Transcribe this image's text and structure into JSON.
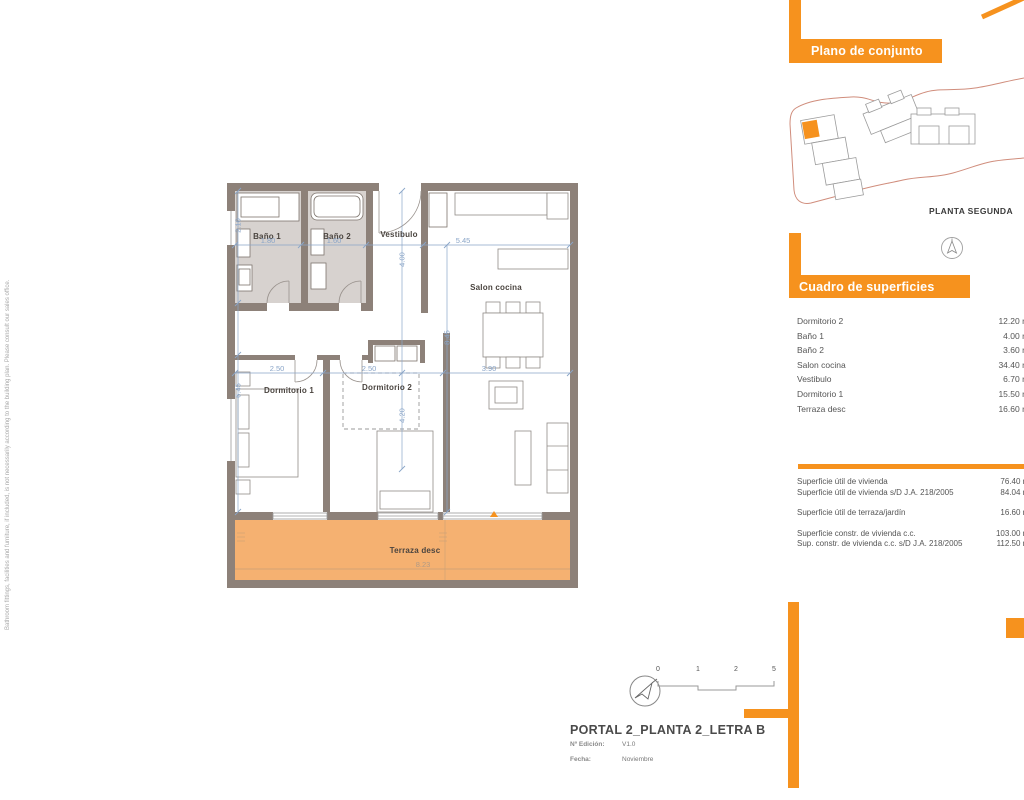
{
  "colors": {
    "accent": "#F6921E",
    "wall": "#8D8179",
    "terrace_fill": "#F5B171",
    "bath_floor": "#D7D2CF",
    "dimension_blue": "#8AA5C8",
    "site_boundary": "#D08D7C"
  },
  "side_note": "Bathroom fittings, facilities and furniture, if included, is not necessarily according to the building plan. Please consult our sales office.",
  "site_plan": {
    "header": "Plano de conjunto",
    "caption": "PLANTA SEGUNDA"
  },
  "surfaces": {
    "header": "Cuadro de superficies",
    "rows": [
      {
        "label": "Dormitorio 2",
        "value": "12.20 m²"
      },
      {
        "label": "Baño 1",
        "value": "4.00 m²"
      },
      {
        "label": "Baño 2",
        "value": "3.60 m²"
      },
      {
        "label": "Salon cocina",
        "value": "34.40 m²"
      },
      {
        "label": "Vestibulo",
        "value": "6.70 m²"
      },
      {
        "label": "Dormitorio 1",
        "value": "15.50 m²"
      },
      {
        "label": "Terraza desc",
        "value": "16.60 m²"
      }
    ],
    "summary": [
      {
        "label": "Superficie útil de vivienda",
        "value": "76.40 m²"
      },
      {
        "label": "Superficie útil de vivienda s/D J.A. 218/2005",
        "value": "84.04 m²"
      },
      {
        "label": "Superficie útil de terraza/jardín",
        "value": "16.60 m²"
      },
      {
        "label": "Superficie constr. de vivienda c.c.",
        "value": "103.00 m²"
      },
      {
        "label": "Sup. constr. de vivienda c.c. s/D J.A. 218/2005",
        "value": "112.50 m²"
      }
    ]
  },
  "plan": {
    "rooms": {
      "banyo1": "Baño 1",
      "banyo2": "Baño 2",
      "vestibulo": "Vestibulo",
      "salon": "Salon cocina",
      "dorm1": "Dormitorio 1",
      "dorm2": "Dormitorio 2",
      "terraza": "Terraza desc"
    },
    "dims": {
      "banyo1_w": "1.80",
      "banyo2_w": "1.60",
      "salon_w": "5.45",
      "vestibulo_h": "4.00",
      "dorm1_w": "2.50",
      "dorm2_w": "2.50",
      "salon_w2": "3.90",
      "salon_h": "8.45",
      "dorm2_h": "4.20",
      "dorm1_h": "6.45",
      "banyo1_h": "2.10",
      "terraza_w": "8.23"
    }
  },
  "scale_bar": {
    "t0": "0",
    "t1": "1",
    "t2": "2",
    "t3": "5"
  },
  "title_block": {
    "title": "PORTAL 2_PLANTA 2_LETRA B",
    "edition_label": "Nº Edición:",
    "edition_value": "V1.0",
    "date_label": "Fecha:",
    "date_value": "Noviembre"
  }
}
